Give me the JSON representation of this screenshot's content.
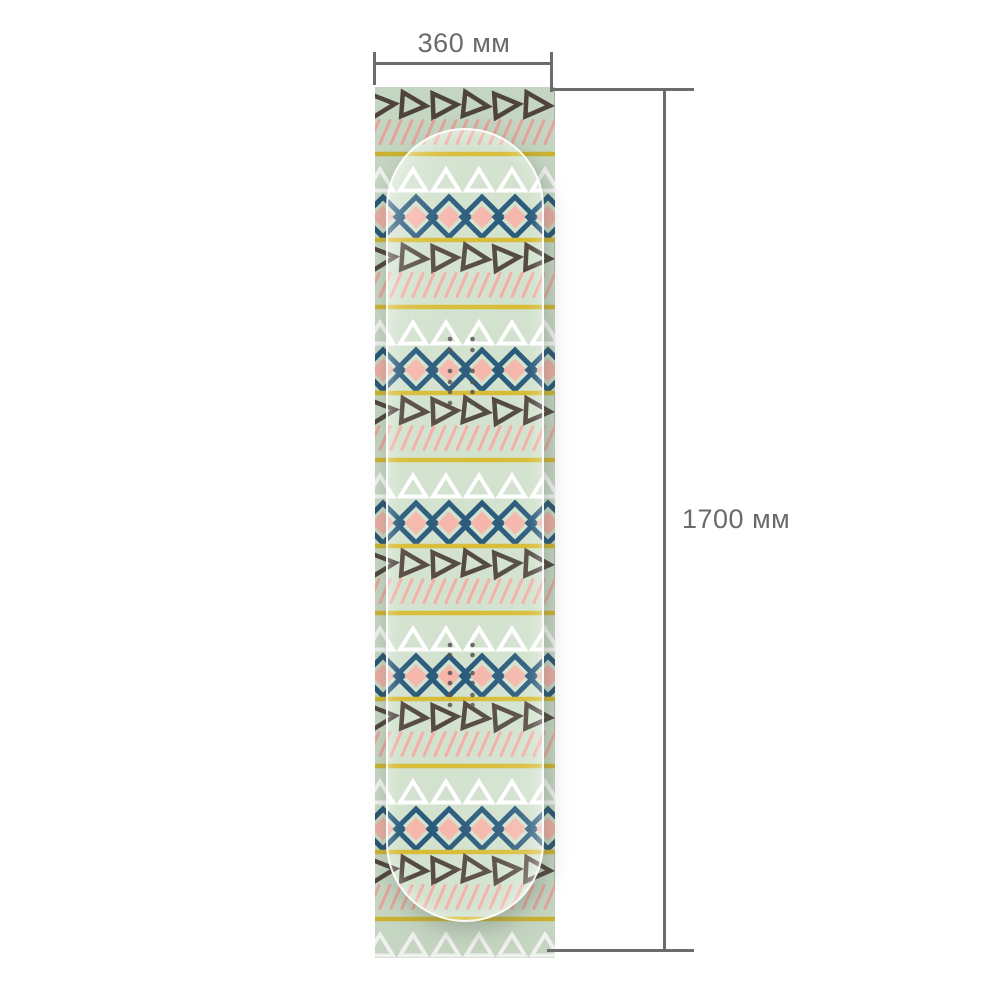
{
  "annotations": {
    "width_label": "360 мм",
    "height_label": "1700 мм",
    "line_color": "#6c6c6c",
    "text_color": "#6a6a6a"
  },
  "sheet": {
    "width_px": 180,
    "height_px": 871,
    "colors": {
      "mint": "#d0e1cc",
      "navy": "#1f5275",
      "pink_fill": "#f6b3a7",
      "pink_line": "#f3aba0",
      "mustard": "#d6b92c",
      "dark": "#4c4039",
      "white": "#ffffff",
      "insert_dot": "#4a4a4a",
      "outside_tint": "rgba(95,110,95,0.10)"
    },
    "cycle": {
      "band_b_height": 67,
      "band_a_height": 86,
      "rows_order": [
        "right-triangles",
        "diagonal-lines",
        "divider-line",
        "up-triangles",
        "diamonds",
        "divider-line"
      ]
    },
    "geometry": {
      "divider": {
        "height": 4.5
      },
      "right_triangles": {
        "offset": 18,
        "start": 7,
        "spacing": 31,
        "count": 7,
        "half_w": 11,
        "half_h": 12,
        "stroke": 4.5,
        "tilts": [
          -5,
          4,
          -2,
          6,
          -4,
          3,
          0
        ]
      },
      "diagonals": {
        "offset": 45,
        "spacing": 11,
        "dx": 10,
        "half_len": 11.5,
        "stroke": 3
      },
      "up_triangles": {
        "offset": 26,
        "start": 5,
        "spacing": 33,
        "count": 6,
        "half_w": 13,
        "half_h": 10.5,
        "stroke": 4
      },
      "diamonds": {
        "offset": 63,
        "start": 8,
        "spacing": 33,
        "count": 6,
        "outer": 20,
        "inner": 11.5,
        "stroke": 5
      }
    },
    "board": {
      "left": 11,
      "top": 41,
      "width": 158,
      "height": 794,
      "radius": 79
    },
    "inserts": {
      "columns_x": [
        75,
        97.5
      ],
      "radius": 2.3,
      "groups": [
        {
          "ys": [
            252,
            263,
            284,
            295,
            305,
            316
          ]
        },
        {
          "ys": [
            558,
            568,
            586,
            596,
            608,
            618
          ]
        }
      ]
    }
  }
}
